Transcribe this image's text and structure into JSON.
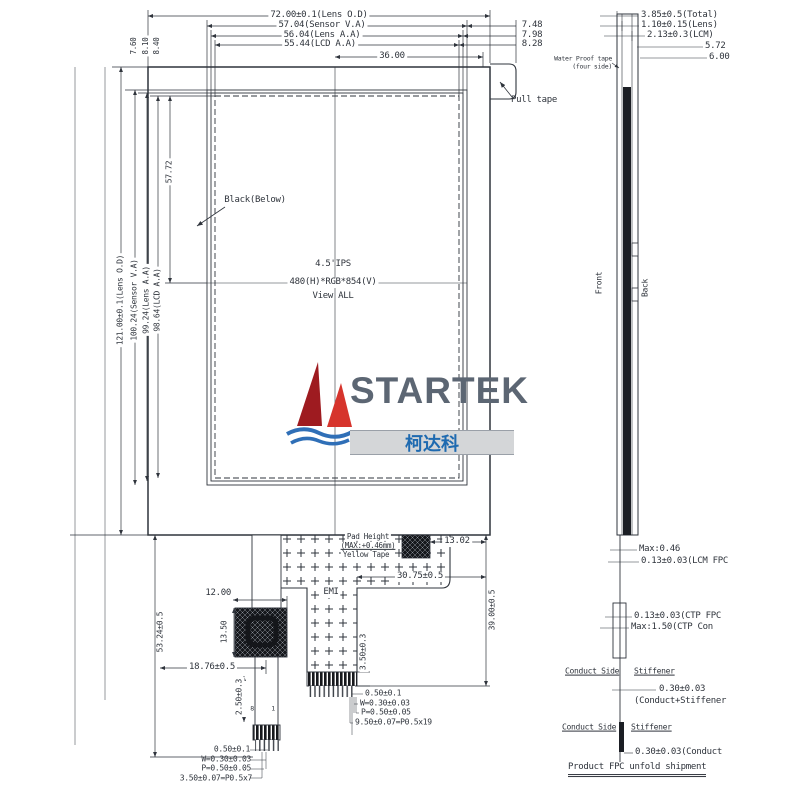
{
  "front": {
    "top_dims": [
      "72.00±0.1(Lens O.D)",
      "57.04(Sensor V.A)",
      "56.04(Lens A.A)",
      "55.44(LCD A.A)",
      "36.00"
    ],
    "top_right_dims": [
      "7.48",
      "7.98",
      "8.28"
    ],
    "top_left_dims": [
      "7.60",
      "8.10",
      "8.40"
    ],
    "left_dims": [
      "121.00±0.1(Lens O.D)",
      "100.24(Sensor V.A)",
      "99.24(Lens A.A)",
      "98.64(LCD A.A)",
      "57.72"
    ],
    "pull_tape": "Pull tape",
    "black_below": "Black(Below)",
    "display": [
      "4.5'IPS",
      "480(H)*RGB*854(V)",
      "View ALL"
    ],
    "pad_note": [
      "Pad Height",
      "(MAX:+0.46mm)",
      "Yellow Tape"
    ],
    "emi": "EMI",
    "dims": {
      "d1302": "13.02",
      "d3075": "30.75±0.5",
      "d3900": "39.00±0.5",
      "d1200": "12.00",
      "d1350": "13.50",
      "d1876": "18.76±0.5",
      "d5324": "53.24±0.5",
      "d250": "2.50±0.3",
      "d350": "3.50±0.3"
    },
    "pins_left": [
      "0.50±0.1",
      "W=0.30±0.03",
      "P=0.50±0.05",
      "3.50±0.07=P0.5x7"
    ],
    "pins_center": [
      "0.50±0.1",
      "W=0.30±0.03",
      "P=0.50±0.05",
      "9.50±0.07=P0.5x19"
    ],
    "pin_numbers": [
      "8",
      "1"
    ]
  },
  "side": {
    "top_dims": [
      "3.85±0.5(Total)",
      "1.10±0.15(Lens)",
      "2.13±0.3(LCM)",
      "5.72",
      "6.00"
    ],
    "tape_note": [
      "Water Proof tape",
      "(four side)"
    ],
    "front_label": "Front",
    "back_label": "Back",
    "max046": "Max:0.46",
    "lcm_fpc": "0.13±0.03(LCM FPC",
    "ctp_fpc": "0.13±0.03(CTP FPC",
    "ctp_con": "Max:1.50(CTP Con",
    "conduct_side": "Conduct Side",
    "stiffener": "Stiffener",
    "conduct_stiffener_dim": "0.30±0.03",
    "conduct_stiffener": "(Conduct+Stiffener",
    "conduct_dim": "0.30±0.03(Conduct",
    "shipment_note": "Product FPC unfold shipment"
  },
  "logo": {
    "brand": "STARTEK",
    "brand_cn": "柯达科"
  },
  "colors": {
    "line": "#2f343c",
    "sail_dark": "#9e1b20",
    "sail_light": "#d6342c",
    "wave": "#2f6fb7",
    "brand_text": "#5c6673",
    "brand_cn_text": "#1e6ab0",
    "band": "#d4d6d8"
  }
}
